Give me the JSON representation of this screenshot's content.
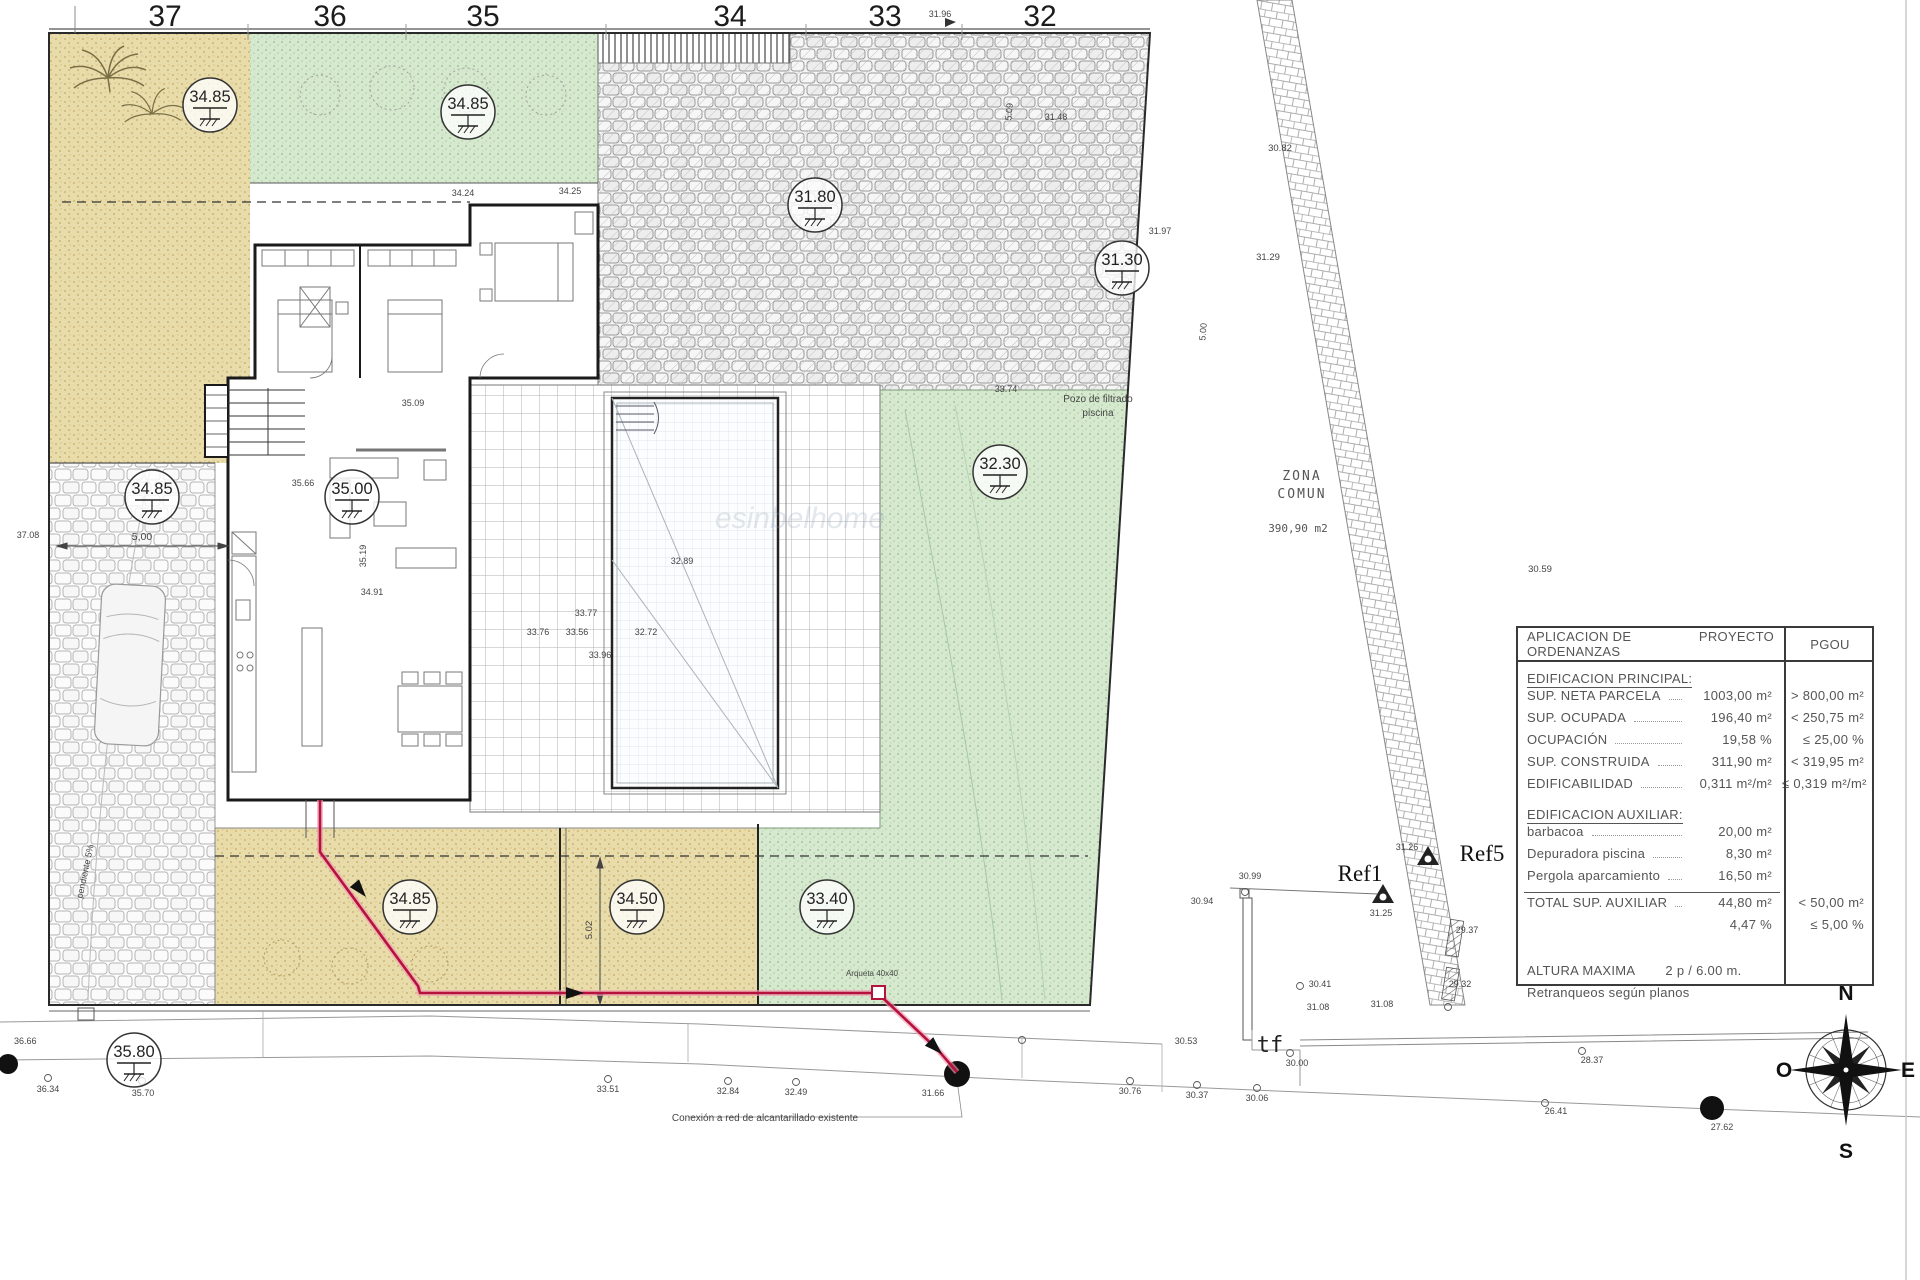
{
  "colors": {
    "sand": "#e9dcab",
    "lawn": "#d4e8cd",
    "cobble_line": "#b5b5b5",
    "red_line": "#b5123e",
    "wall": "#1a1a1a"
  },
  "ruler": {
    "marks": [
      {
        "t": "37",
        "x": 165
      },
      {
        "t": "36",
        "x": 330
      },
      {
        "t": "35",
        "x": 483
      },
      {
        "t": "34",
        "x": 730
      },
      {
        "t": "33",
        "x": 885
      },
      {
        "t": "32",
        "x": 1040
      }
    ]
  },
  "elevations": [
    {
      "v": "34.85",
      "x": 210,
      "y": 105
    },
    {
      "v": "34.85",
      "x": 468,
      "y": 112
    },
    {
      "v": "31.80",
      "x": 815,
      "y": 205
    },
    {
      "v": "31.30",
      "x": 1122,
      "y": 268
    },
    {
      "v": "34.85",
      "x": 152,
      "y": 497
    },
    {
      "v": "35.00",
      "x": 352,
      "y": 497
    },
    {
      "v": "32.30",
      "x": 1000,
      "y": 472
    },
    {
      "v": "34.85",
      "x": 410,
      "y": 907
    },
    {
      "v": "34.50",
      "x": 637,
      "y": 907
    },
    {
      "v": "33.40",
      "x": 827,
      "y": 907
    },
    {
      "v": "35.80",
      "x": 134,
      "y": 1060
    }
  ],
  "labels": [
    {
      "t": "37.08",
      "x": 28,
      "y": 538,
      "s": 9
    },
    {
      "t": "5,00",
      "x": 142,
      "y": 540,
      "s": 10.5
    },
    {
      "t": "36.66",
      "x": 14,
      "y": 1044,
      "s": 9,
      "a": "start"
    },
    {
      "t": "36.34",
      "x": 48,
      "y": 1092,
      "s": 9
    },
    {
      "t": "35.70",
      "x": 143,
      "y": 1096,
      "s": 9
    },
    {
      "t": "33.51",
      "x": 608,
      "y": 1092,
      "s": 9
    },
    {
      "t": "32.84",
      "x": 728,
      "y": 1094,
      "s": 9
    },
    {
      "t": "32.49",
      "x": 796,
      "y": 1095,
      "s": 9
    },
    {
      "t": "31.66",
      "x": 933,
      "y": 1096,
      "s": 9
    },
    {
      "t": "30.76",
      "x": 1130,
      "y": 1094,
      "s": 9
    },
    {
      "t": "30.37",
      "x": 1197,
      "y": 1098,
      "s": 9
    },
    {
      "t": "30.06",
      "x": 1257,
      "y": 1101,
      "s": 9
    },
    {
      "t": "30.53",
      "x": 1186,
      "y": 1044,
      "s": 9
    },
    {
      "t": "tf",
      "x": 1270,
      "y": 1052,
      "s": 22,
      "f": "mono",
      "c": "#222",
      "n": "tf-label"
    },
    {
      "t": "30.00",
      "x": 1297,
      "y": 1066,
      "s": 9
    },
    {
      "t": "28.37",
      "x": 1592,
      "y": 1063,
      "s": 9
    },
    {
      "t": "26.41",
      "x": 1556,
      "y": 1114,
      "s": 9
    },
    {
      "t": "27.62",
      "x": 1722,
      "y": 1130,
      "s": 9
    },
    {
      "t": "30.94",
      "x": 1202,
      "y": 904,
      "s": 9
    },
    {
      "t": "30.99",
      "x": 1250,
      "y": 879,
      "s": 9
    },
    {
      "t": "Ref1",
      "x": 1360,
      "y": 881,
      "s": 23,
      "f": "serif",
      "c": "#111",
      "n": "ref1-label"
    },
    {
      "t": "Ref5",
      "x": 1482,
      "y": 861,
      "s": 23,
      "f": "serif",
      "c": "#111",
      "n": "ref5-label"
    },
    {
      "t": "31.25",
      "x": 1381,
      "y": 916,
      "s": 9
    },
    {
      "t": "31.26",
      "x": 1407,
      "y": 850,
      "s": 9
    },
    {
      "t": "29.37",
      "x": 1467,
      "y": 933,
      "s": 9
    },
    {
      "t": "29.32",
      "x": 1460,
      "y": 987,
      "s": 9
    },
    {
      "t": "30.41",
      "x": 1320,
      "y": 987,
      "s": 9
    },
    {
      "t": "31.08",
      "x": 1318,
      "y": 1010,
      "s": 9
    },
    {
      "t": "31.08",
      "x": 1382,
      "y": 1007,
      "s": 9
    },
    {
      "t": "30.82",
      "x": 1280,
      "y": 151,
      "s": 9.5
    },
    {
      "t": "31.29",
      "x": 1268,
      "y": 260,
      "s": 9.5
    },
    {
      "t": "30.59",
      "x": 1540,
      "y": 572,
      "s": 9.5
    },
    {
      "t": "31.96",
      "x": 940,
      "y": 17,
      "s": 9
    },
    {
      "t": "ZONA",
      "x": 1302,
      "y": 480,
      "s": 13,
      "f": "mono",
      "c": "#555",
      "ls": 2,
      "n": "zona-comun-label"
    },
    {
      "t": "COMUN",
      "x": 1302,
      "y": 498,
      "s": 13,
      "f": "mono",
      "c": "#555",
      "ls": 2,
      "n": "zona-comun-label"
    },
    {
      "t": "390,90 m2",
      "x": 1298,
      "y": 532,
      "s": 11,
      "f": "mono",
      "c": "#555",
      "n": "zona-comun-area"
    },
    {
      "t": "Pozo de filtrado",
      "x": 1098,
      "y": 402,
      "s": 10,
      "n": "pool-filter-note"
    },
    {
      "t": "piscina",
      "x": 1098,
      "y": 416,
      "s": 10,
      "n": "pool-filter-note"
    },
    {
      "t": "Conexión a red de alcantarillado existente",
      "x": 765,
      "y": 1121,
      "s": 10,
      "n": "sewer-note"
    },
    {
      "t": "Arqueta 40x40",
      "x": 872,
      "y": 976,
      "s": 8,
      "n": "arqueta-label"
    },
    {
      "t": "pendiente 5%",
      "x": 88,
      "y": 872,
      "s": 9,
      "r": -78,
      "n": "slope-label"
    },
    {
      "t": "5.02",
      "x": 592,
      "y": 930,
      "s": 9.5,
      "r": -90
    },
    {
      "t": "5.09",
      "x": 1012,
      "y": 112,
      "s": 9,
      "r": -85
    },
    {
      "t": "5.00",
      "x": 1206,
      "y": 332,
      "s": 9,
      "r": -85
    },
    {
      "t": "31.48",
      "x": 1056,
      "y": 120,
      "s": 9
    },
    {
      "t": "31.97",
      "x": 1160,
      "y": 234,
      "s": 9
    },
    {
      "t": "33.74",
      "x": 1006,
      "y": 392,
      "s": 9
    },
    {
      "t": "35.09",
      "x": 413,
      "y": 406,
      "s": 9
    },
    {
      "t": "34.91",
      "x": 372,
      "y": 595,
      "s": 9
    },
    {
      "t": "35.66",
      "x": 303,
      "y": 486,
      "s": 9
    },
    {
      "t": "35.19",
      "x": 366,
      "y": 556,
      "s": 9,
      "r": -90
    },
    {
      "t": "33.77",
      "x": 586,
      "y": 616,
      "s": 9
    },
    {
      "t": "33.96",
      "x": 600,
      "y": 658,
      "s": 9
    },
    {
      "t": "33.76",
      "x": 538,
      "y": 635,
      "s": 9
    },
    {
      "t": "33.56",
      "x": 577,
      "y": 635,
      "s": 9
    },
    {
      "t": "32.72",
      "x": 646,
      "y": 635,
      "s": 9
    },
    {
      "t": "32.89",
      "x": 682,
      "y": 564,
      "s": 9
    },
    {
      "t": "34.24",
      "x": 463,
      "y": 196,
      "s": 9
    },
    {
      "t": "34.25",
      "x": 570,
      "y": 194,
      "s": 9
    },
    {
      "t": "esinbelhome",
      "x": 800,
      "y": 528,
      "s": 30,
      "c": "#8fa3b8",
      "o": 0.25,
      "i": 1,
      "n": "watermark"
    }
  ],
  "compass": {
    "points": [
      {
        "t": "N",
        "x": 1846,
        "y": 1000,
        "s": 21,
        "b": 1,
        "c": "#111",
        "n": "compass-n"
      },
      {
        "t": "S",
        "x": 1846,
        "y": 1158,
        "s": 21,
        "b": 1,
        "c": "#111",
        "n": "compass-s"
      },
      {
        "t": "E",
        "x": 1908,
        "y": 1077,
        "s": 21,
        "b": 1,
        "c": "#111",
        "n": "compass-e"
      },
      {
        "t": "O",
        "x": 1784,
        "y": 1077,
        "s": 21,
        "b": 1,
        "c": "#111",
        "n": "compass-o"
      }
    ]
  },
  "table": {
    "header": {
      "col1": "APLICACION DE ORDENANZAS",
      "col2": "PROYECTO",
      "col3": "PGOU"
    },
    "section1": "EDIFICACION PRINCIPAL:",
    "rows1": [
      {
        "label": "SUP. NETA PARCELA",
        "value": "1003,00 m²",
        "pgou": "> 800,00 m²"
      },
      {
        "label": "SUP. OCUPADA",
        "value": "196,40 m²",
        "pgou": "< 250,75 m²"
      },
      {
        "label": "OCUPACIÓN",
        "value": "19,58 %",
        "pgou": "≤ 25,00 %"
      },
      {
        "label": "SUP. CONSTRUIDA",
        "value": "311,90 m²",
        "pgou": "< 319,95 m²"
      },
      {
        "label": "EDIFICABILIDAD",
        "value": "0,311 m²/m²",
        "pgou": "≤ 0,319 m²/m²"
      }
    ],
    "section2": "EDIFICACION AUXILIAR:",
    "rows2": [
      {
        "label": "barbacoa",
        "value": "20,00 m²",
        "pgou": ""
      },
      {
        "label": "Depuradora piscina",
        "value": "8,30 m²",
        "pgou": ""
      },
      {
        "label": "Pergola aparcamiento",
        "value": "16,50 m²",
        "pgou": ""
      }
    ],
    "total": {
      "label": "TOTAL SUP. AUXILIAR",
      "value": "44,80 m²",
      "pgou": "< 50,00 m²"
    },
    "total_pct": {
      "value": "4,47 %",
      "pgou": "≤ 5,00 %"
    },
    "altura": {
      "label": "ALTURA MAXIMA",
      "value": "2 p / 6.00 m."
    },
    "retranqueos": "Retranqueos según planos"
  }
}
